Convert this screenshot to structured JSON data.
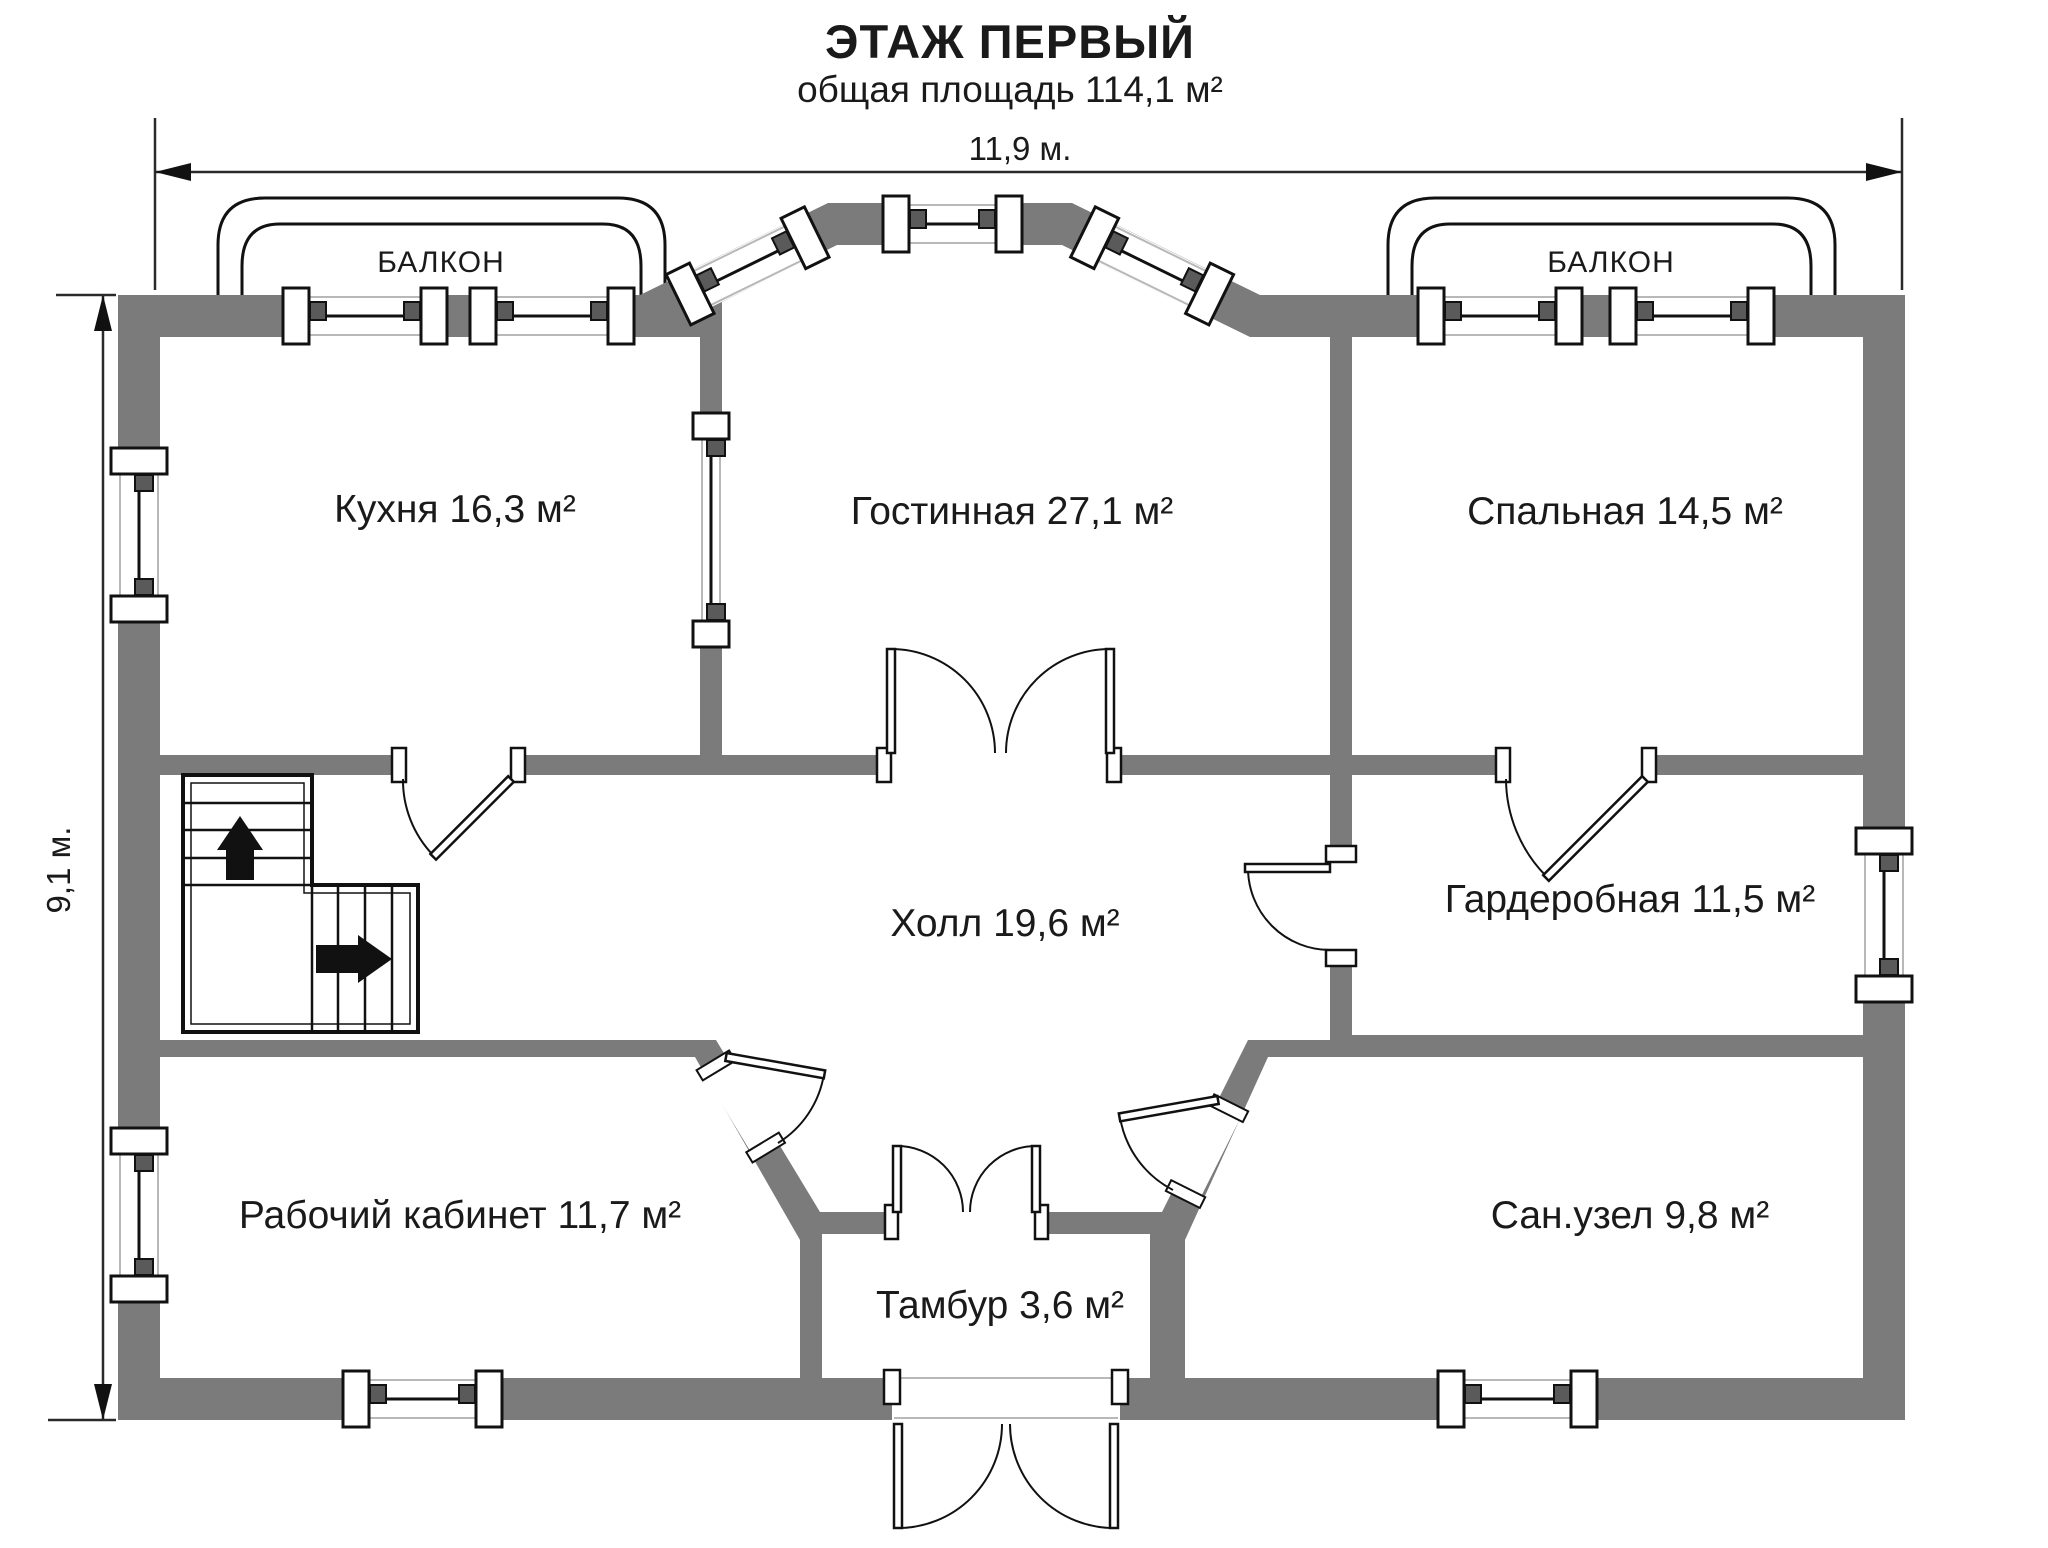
{
  "title": "ЭТАЖ ПЕРВЫЙ",
  "subtitle": "общая площадь 114,1 м²",
  "dimensions": {
    "width_label": "11,9 м.",
    "height_label": "9,1 м."
  },
  "balconies": {
    "left_label": "БАЛКОН",
    "right_label": "БАЛКОН"
  },
  "rooms": [
    {
      "id": "kitchen",
      "label": "Кухня 16,3 м²"
    },
    {
      "id": "living",
      "label": "Гостинная 27,1 м²"
    },
    {
      "id": "bedroom",
      "label": "Спальная 14,5 м²"
    },
    {
      "id": "hall",
      "label": "Холл 19,6 м²"
    },
    {
      "id": "wardrobe",
      "label": "Гардеробная 11,5 м²"
    },
    {
      "id": "office",
      "label": "Рабочий кабинет 11,7 м²"
    },
    {
      "id": "bathroom",
      "label": "Сан.узел 9,8 м²"
    },
    {
      "id": "tambour",
      "label": "Тамбур 3,6 м²"
    }
  ],
  "colors": {
    "wall_gray": "#7b7b7b",
    "line_black": "#111111"
  }
}
